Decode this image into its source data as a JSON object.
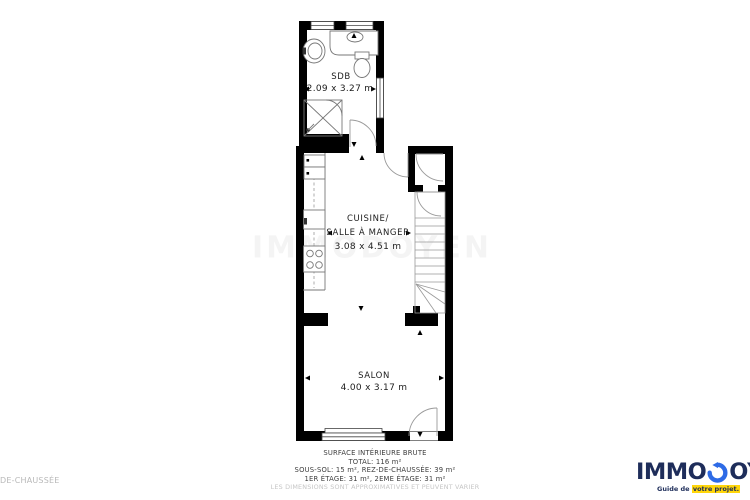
{
  "page_label": "DE-CHAUSSÉE",
  "watermark": "IMMODOYEN",
  "rooms": {
    "sdb": {
      "name": "SDB",
      "dims": "2.09 x 3.27 m"
    },
    "cuisine": {
      "name_line1": "CUISINE/",
      "name_line2": "SALLE À MANGER",
      "dims": "3.08 x 4.51 m"
    },
    "salon": {
      "name": "SALON",
      "dims": "4.00 x 3.17 m"
    }
  },
  "footer": {
    "line1": "SURFACE INTÉRIEURE BRUTE",
    "line2": "TOTAL: 116 m²",
    "line3": "SOUS-SOL: 15 m², REZ-DE-CHAUSSÉE: 39 m²",
    "line4": "1ER ÉTAGE: 31 m², 2EME ÉTAGE: 31 m²",
    "disclaimer": "LES DIMENSIONS SONT APPROXIMATIVES ET PEUVENT VARIER"
  },
  "logo": {
    "part1": "IMMO",
    "part2": "OYEN",
    "tagline_pre": "Guide de ",
    "tagline_highlight": "votre projet.",
    "colors": {
      "navy": "#1e2d5a",
      "blue": "#2e6be6",
      "yellow": "#ffd60a"
    }
  },
  "plan_colors": {
    "wall": "#000000",
    "fixture_line": "#777777",
    "arc_line": "#999999"
  }
}
